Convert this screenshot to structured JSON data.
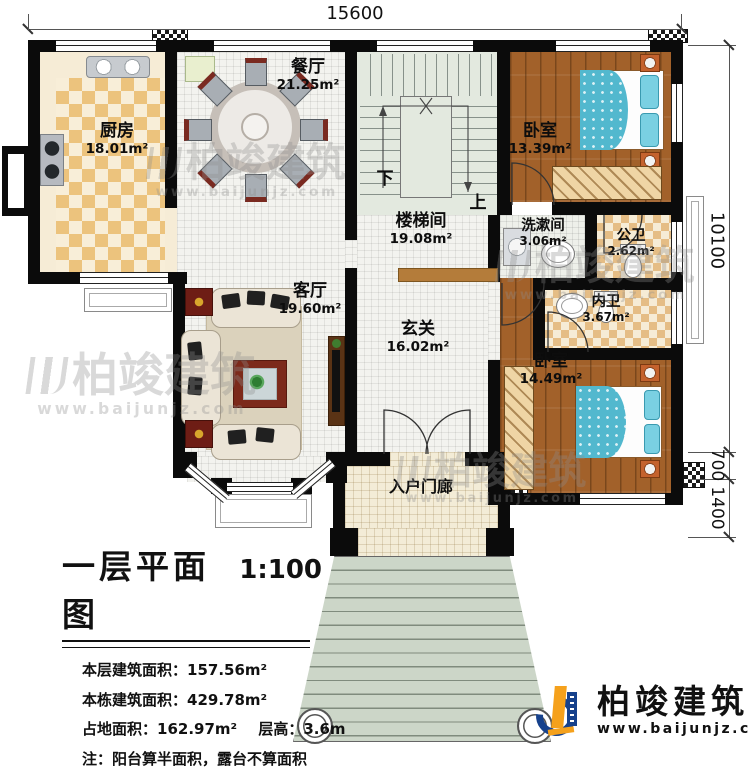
{
  "dimensions": {
    "top": "15600",
    "right_main": "10100",
    "right_mid": "700",
    "right_low": "1400"
  },
  "rooms": {
    "kitchen": {
      "name": "厨房",
      "area": "18.01m²"
    },
    "dining": {
      "name": "餐厅",
      "area": "21.25m²"
    },
    "stairwell": {
      "name": "楼梯间",
      "area": "19.08m²"
    },
    "bedroom_top": {
      "name": "卧室",
      "area": "13.39m²"
    },
    "washroom": {
      "name": "洗漱间",
      "area": "3.06m²"
    },
    "public_bath": {
      "name": "公卫",
      "area": "2.62m²"
    },
    "ensuite_bath": {
      "name": "内卫",
      "area": "3.67m²"
    },
    "living": {
      "name": "客厅",
      "area": "19.60m²"
    },
    "foyer": {
      "name": "玄关",
      "area": "16.02m²"
    },
    "bedroom_bottom": {
      "name": "卧室",
      "area": "14.49m²"
    },
    "porch": {
      "name": "入户门廊"
    }
  },
  "stairs": {
    "down": "下",
    "up": "上"
  },
  "watermark": {
    "brand": "柏竣建筑",
    "url": "www.baijunjz.com"
  },
  "logo": {
    "brand": "柏竣建筑",
    "url": "www.baijunjz.com"
  },
  "title_block": {
    "title": "一层平面图",
    "scale": "1:100",
    "line1_label": "本层建筑面积：",
    "line1_value": "157.56m²",
    "line2_label": "本栋建筑面积：",
    "line2_value": "429.78m²",
    "line3a_label": "占地面积：",
    "line3a_value": "162.97m²",
    "line3b_label": "层高：",
    "line3b_value": "3.6m",
    "note": "注：阳台算半面积，露台不算面积"
  },
  "colors": {
    "wall": "#0b0b0b",
    "wood_floor": "#a2612a",
    "bed": "#52b8ce",
    "logo_blue": "#16418c",
    "logo_orange": "#f5a11c"
  }
}
